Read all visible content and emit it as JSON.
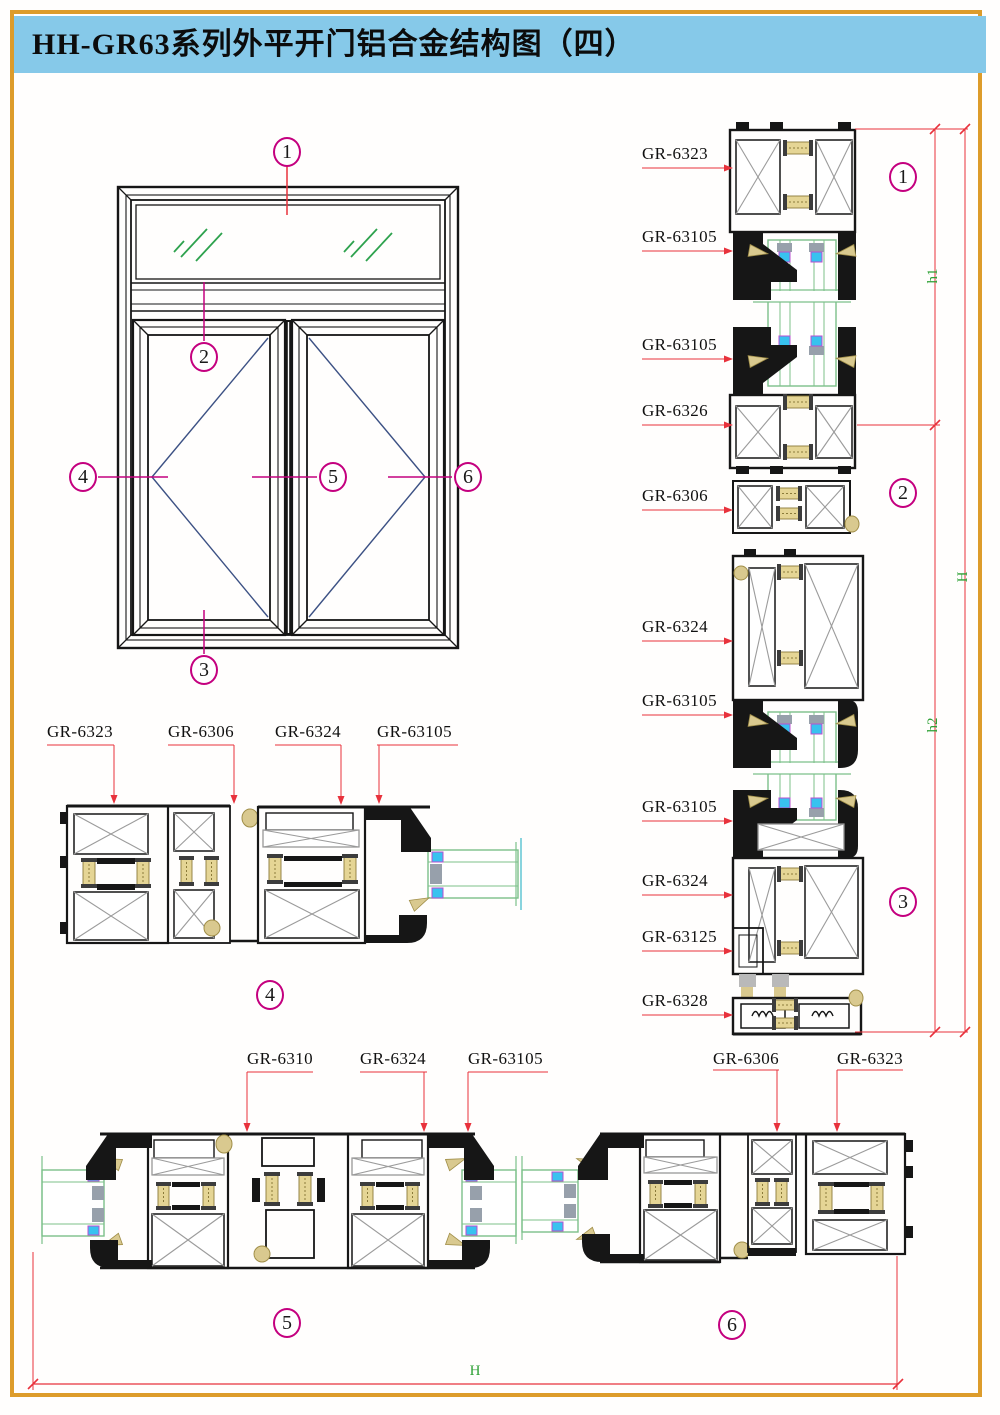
{
  "title": "HH-GR63系列外平开门铝合金结构图（四）",
  "colors": {
    "page_border": "#dd9c2b",
    "title_bg": "#86c9e9",
    "ink": "#161616",
    "detail_gray": "#9b9b9b",
    "connector_fill": "#e5d595",
    "connector_edge": "#8c7b3a",
    "gasket_tan": "#d9c98f",
    "glass_green": "#7cc08a",
    "hatch_green": "#2ea24e",
    "gasket_cyan": "#38c2ef",
    "gasket_outline": "#b84fd0",
    "spacer_gray": "#97a0ab",
    "leader_red": "#e8323c",
    "callout_magenta": "#c4007f",
    "dim_green": "#2fa136",
    "swing_navy": "#3c5184"
  },
  "elevation": {
    "callouts": [
      "1",
      "2",
      "3",
      "4",
      "5",
      "6"
    ]
  },
  "right_sections": {
    "callouts": [
      "1",
      "2",
      "3"
    ],
    "labels": [
      "GR-6323",
      "GR-63105",
      "GR-63105",
      "GR-6326",
      "GR-6306",
      "GR-6324",
      "GR-63105",
      "GR-63105",
      "GR-6324",
      "GR-63125",
      "GR-6328"
    ],
    "dims": {
      "h1": "h1",
      "h2": "h2",
      "total": "H"
    }
  },
  "section4": {
    "callout": "4",
    "labels": [
      "GR-6323",
      "GR-6306",
      "GR-6324",
      "GR-63105"
    ]
  },
  "section5": {
    "callout": "5",
    "labels": [
      "GR-6310",
      "GR-6324",
      "GR-63105"
    ]
  },
  "section6": {
    "callout": "6",
    "labels": [
      "GR-6306",
      "GR-6323"
    ]
  },
  "bottom_dim": {
    "label": "H"
  }
}
